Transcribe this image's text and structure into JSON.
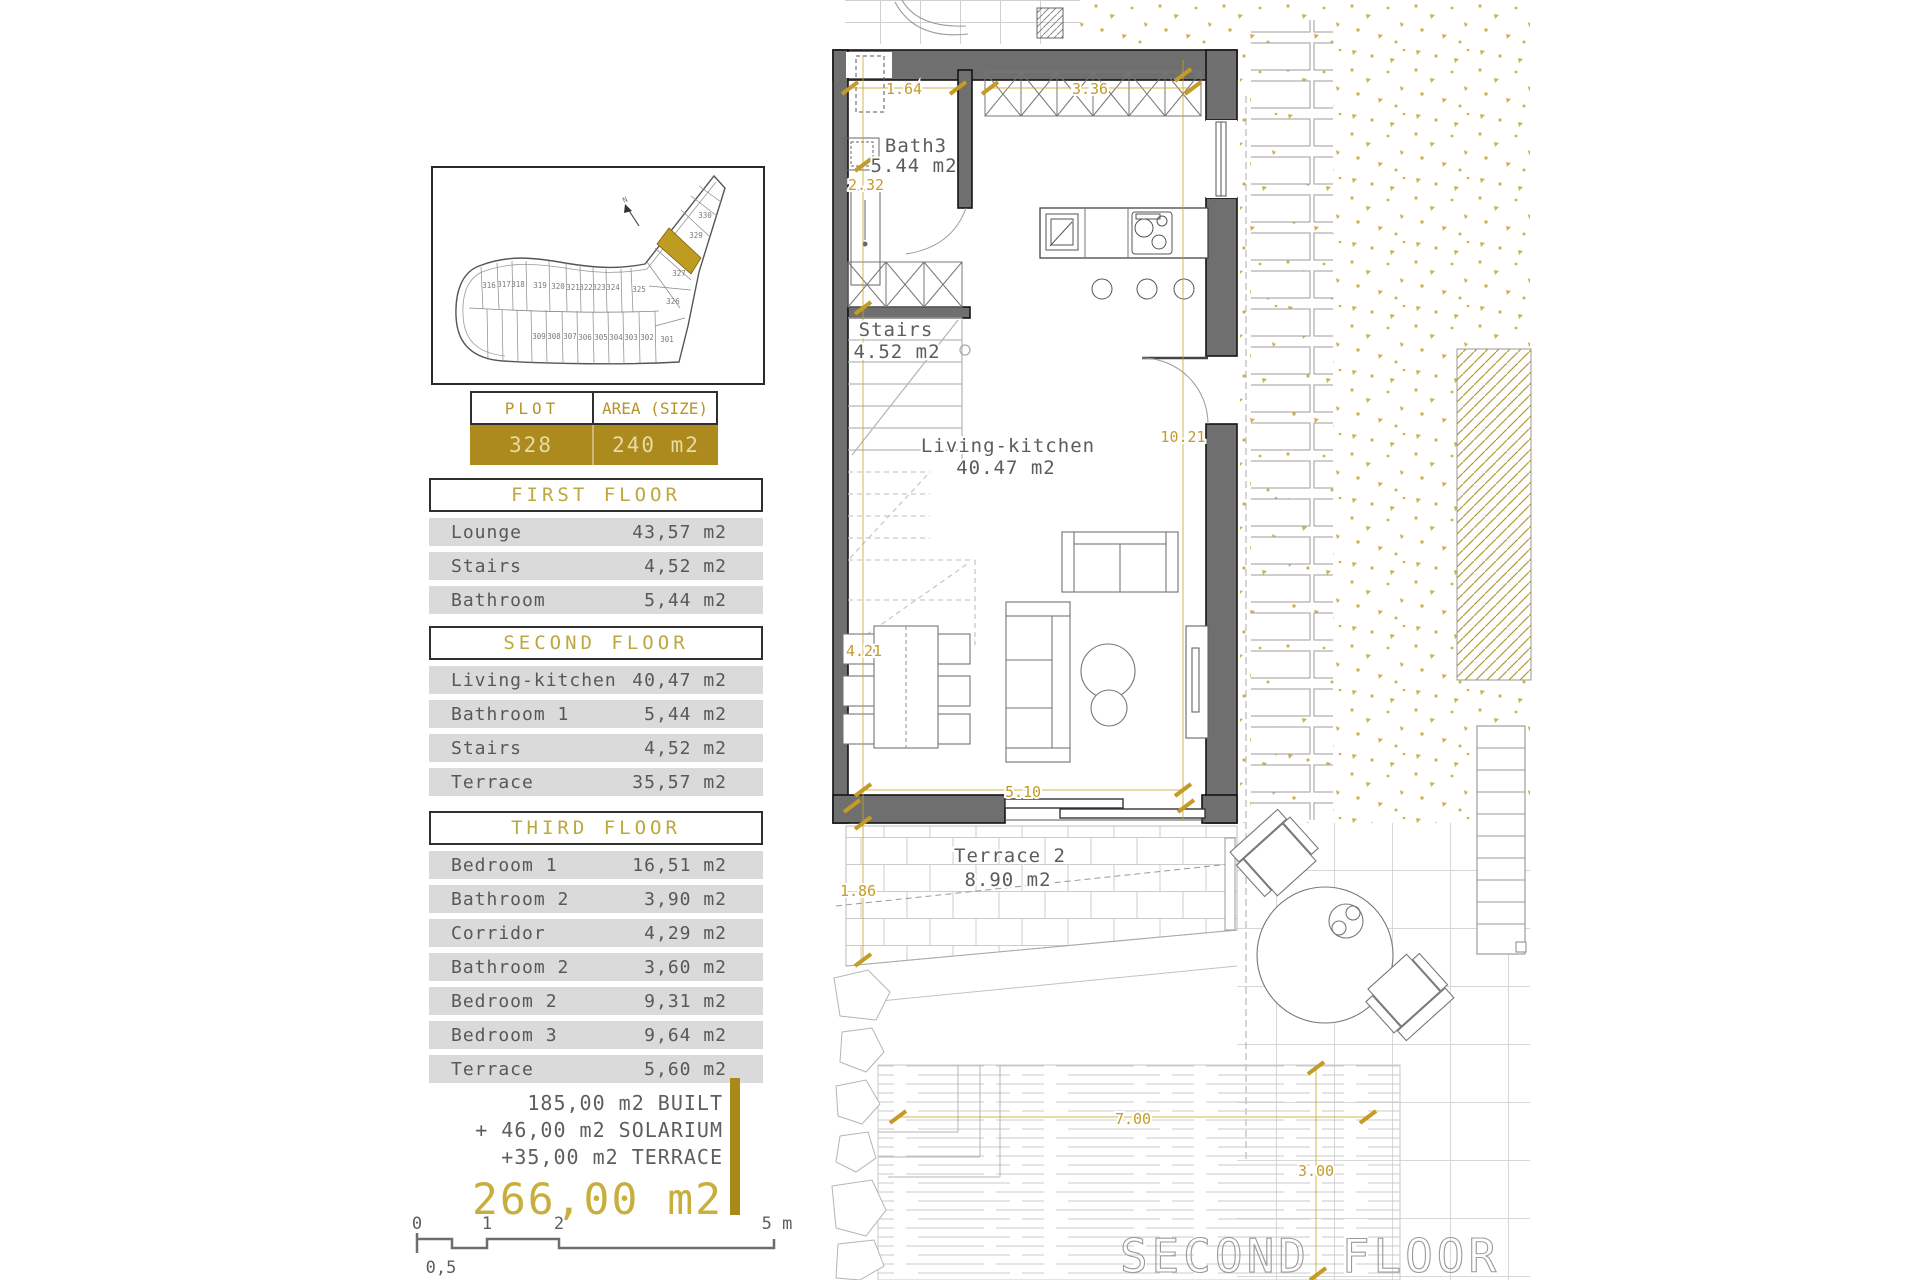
{
  "colors": {
    "gold": "#B08C1E",
    "gold_dim": "#C49B26",
    "wall_gray": "#6F6F6F",
    "row_gray": "#DADADA"
  },
  "site_plan": {
    "north": "N",
    "top_row": [
      "316",
      "317",
      "318",
      "319",
      "320",
      "321",
      "322",
      "323",
      "324"
    ],
    "bottom_row": [
      "309",
      "308",
      "307",
      "306",
      "305",
      "304",
      "303",
      "302",
      "301"
    ],
    "wedge": [
      "330",
      "329",
      "327",
      "326",
      "325"
    ],
    "highlighted_plot": "328"
  },
  "plot_table": {
    "plot_header": "PLOT",
    "area_header": "AREA (SIZE)",
    "plot_value": "328",
    "area_value": "240 m2"
  },
  "floors": [
    {
      "title": "FIRST FLOOR",
      "rows": [
        {
          "name": "Lounge",
          "area": "43,57 m2"
        },
        {
          "name": "Stairs",
          "area": "4,52 m2"
        },
        {
          "name": "Bathroom",
          "area": "5,44 m2"
        }
      ]
    },
    {
      "title": "SECOND FLOOR",
      "rows": [
        {
          "name": "Living-kitchen",
          "area": "40,47 m2"
        },
        {
          "name": "Bathroom 1",
          "area": "5,44 m2"
        },
        {
          "name": "Stairs",
          "area": "4,52 m2"
        },
        {
          "name": "Terrace",
          "area": "35,57 m2"
        }
      ]
    },
    {
      "title": "THIRD FLOOR",
      "rows": [
        {
          "name": "Bedroom 1",
          "area": "16,51 m2"
        },
        {
          "name": "Bathroom 2",
          "area": "3,90 m2"
        },
        {
          "name": "Corridor",
          "area": "4,29 m2"
        },
        {
          "name": "Bathroom 2",
          "area": "3,60 m2"
        },
        {
          "name": "Bedroom 2",
          "area": "9,31 m2"
        },
        {
          "name": "Bedroom 3",
          "area": "9,64 m2"
        },
        {
          "name": "Terrace",
          "area": "5,60 m2"
        }
      ]
    }
  ],
  "summary": {
    "line1": "185,00 m2 BUILT",
    "line2": "+ 46,00 m2 SOLARIUM",
    "line3": "+35,00 m2 TERRACE",
    "total": "266,00 m2"
  },
  "scale_bar": {
    "labels": [
      "0",
      "1",
      "2",
      "5 m"
    ],
    "half_label": "0,5"
  },
  "plan": {
    "floor_label": "SECOND FLOOR",
    "rooms": {
      "bath": {
        "name": "Bath3",
        "area": "5.44 m2"
      },
      "stairs": {
        "name": "Stairs",
        "area": "4.52 m2"
      },
      "living": {
        "name": "Living-kitchen",
        "area": "40.47 m2"
      },
      "terrace": {
        "name": "Terrace 2",
        "area": "8.90 m2"
      }
    },
    "dims": {
      "bath_width": "1.64",
      "kitchen_width": "3.36",
      "bath_height": "2.32",
      "side_height": "10.21",
      "living_height": "4.21",
      "living_width": "5.10",
      "terrace_height": "1.86",
      "pool_width": "7.00",
      "pool_depth": "3.00"
    }
  }
}
